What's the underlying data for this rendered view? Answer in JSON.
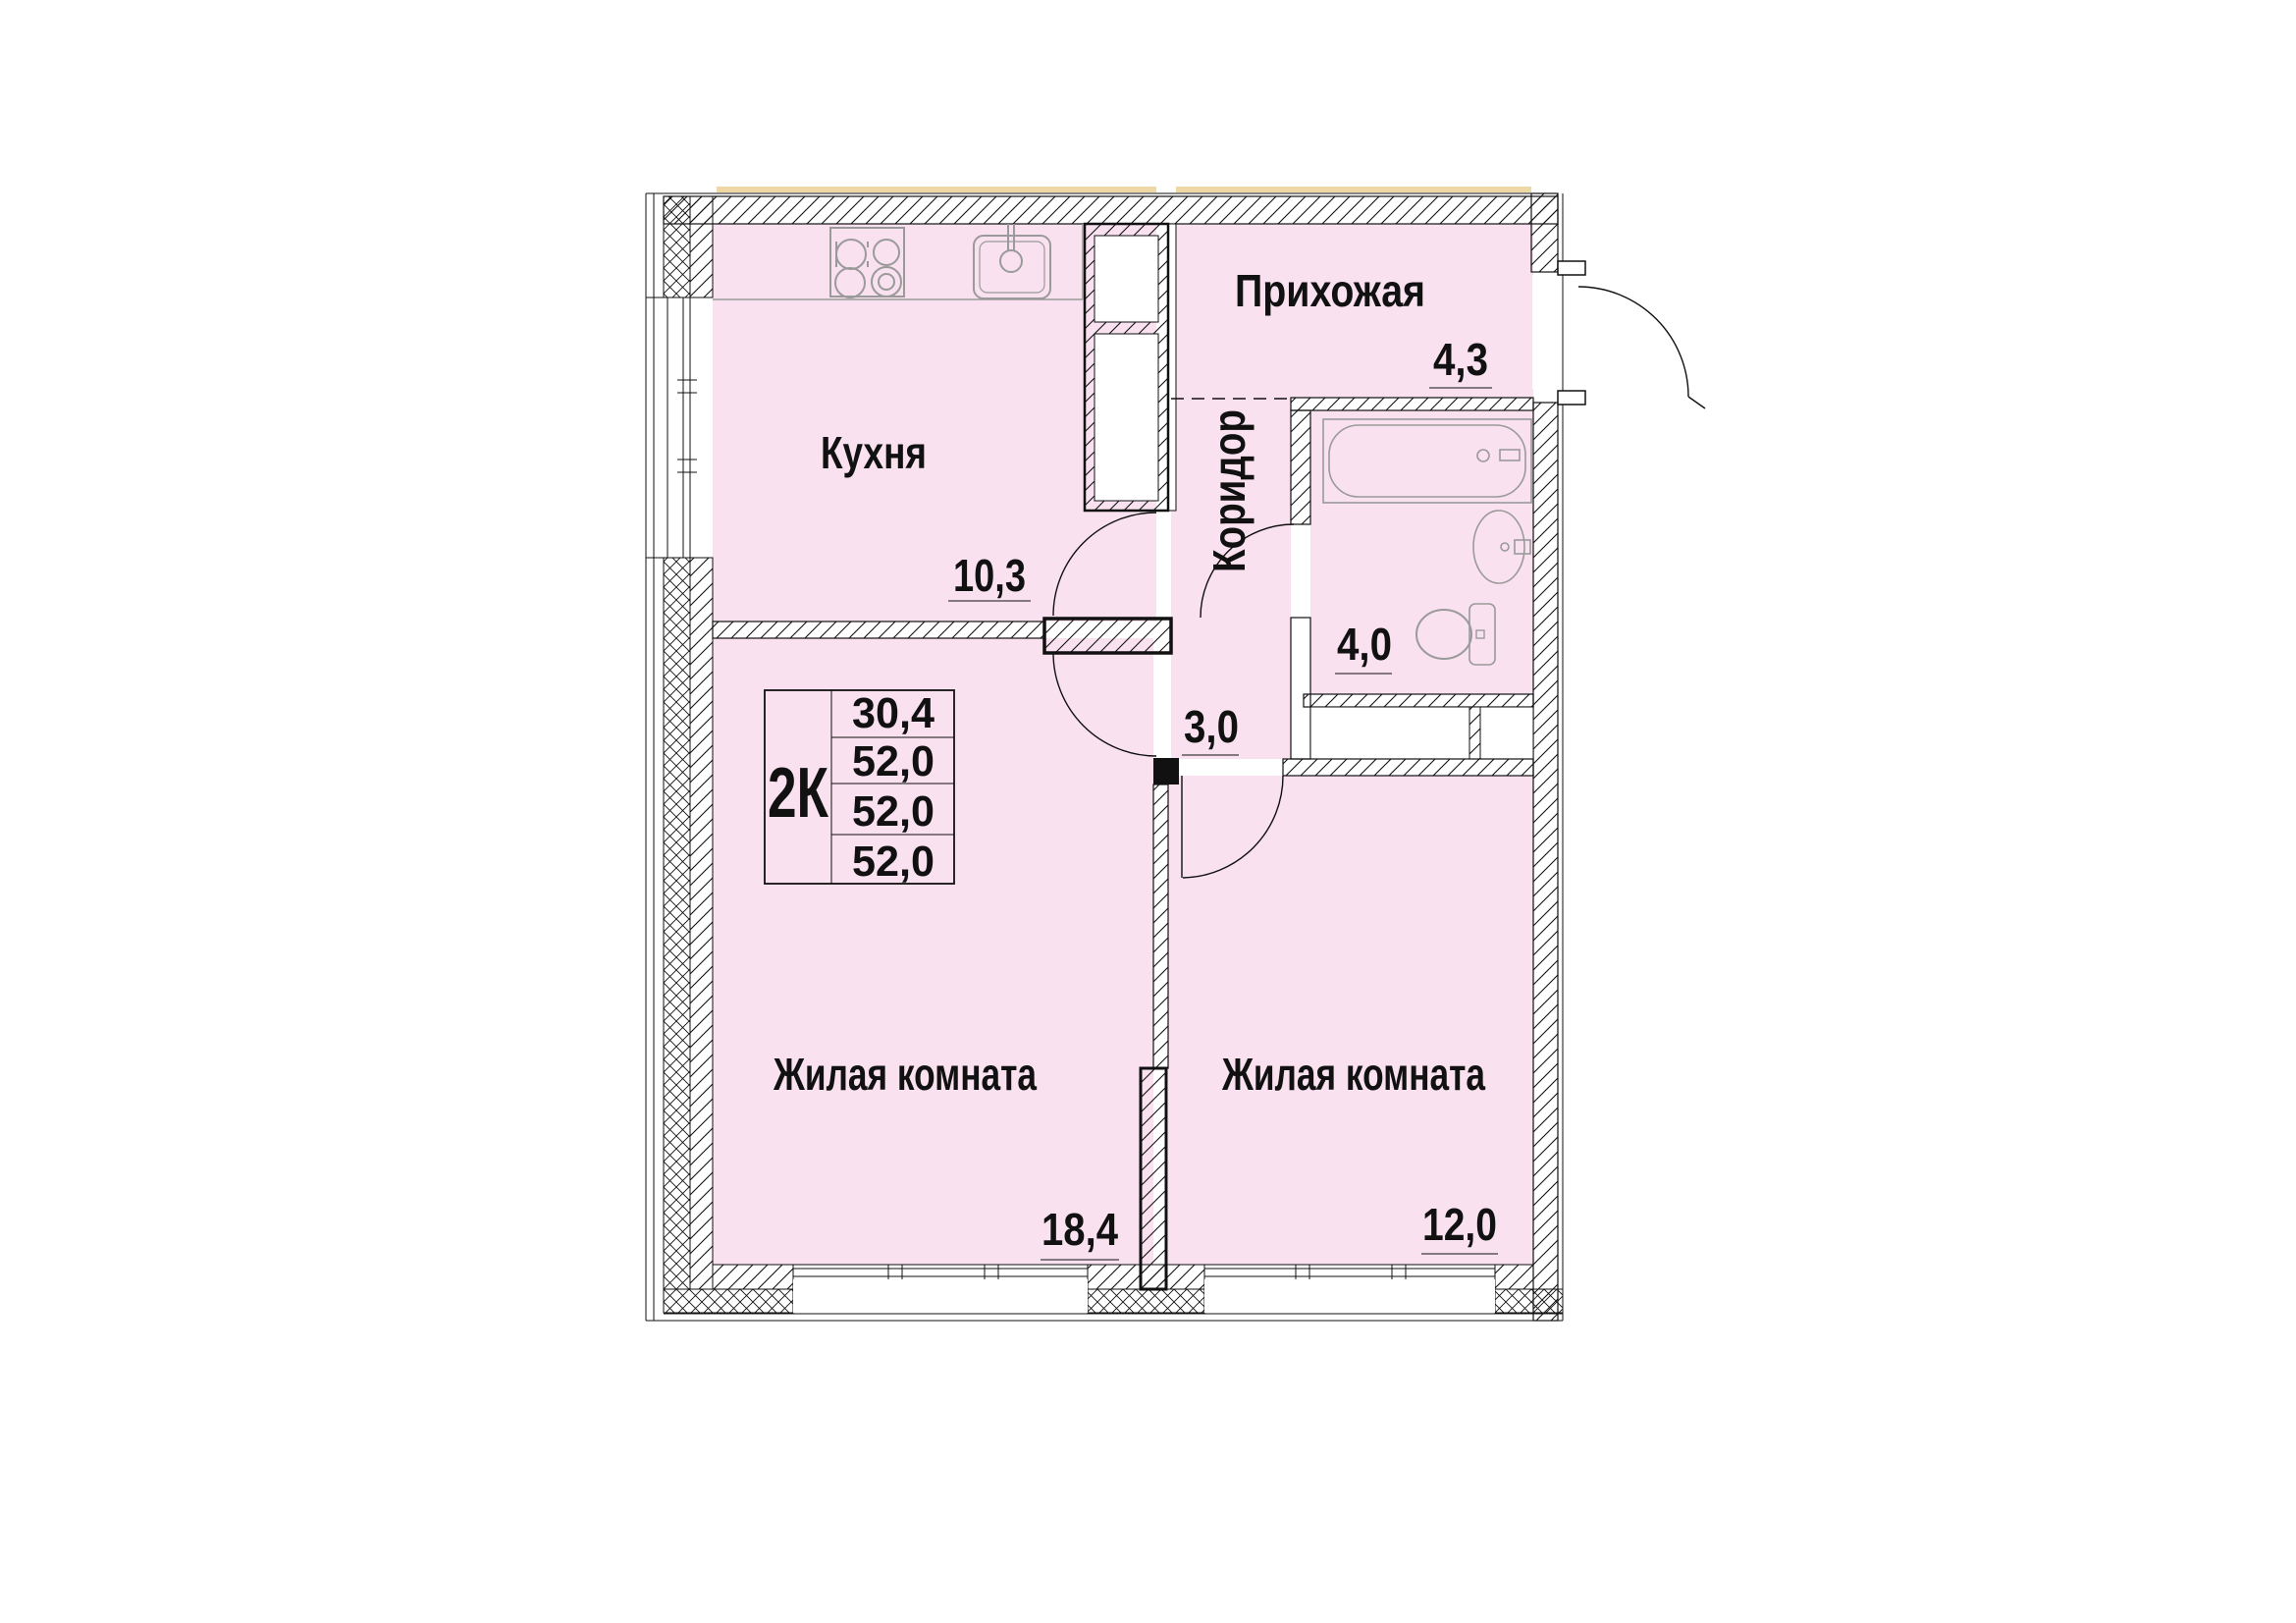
{
  "floor_plan": {
    "summary": {
      "type_label": "2К",
      "rows": [
        "30,4",
        "52,0",
        "52,0",
        "52,0"
      ]
    },
    "rooms": [
      {
        "id": "kitchen",
        "label": "Кухня",
        "area": "10,3"
      },
      {
        "id": "hallway",
        "label": "Прихожая",
        "area": "4,3"
      },
      {
        "id": "corridor",
        "label": "Коридор",
        "area": "3,0"
      },
      {
        "id": "bathroom",
        "label": "",
        "area": "4,0"
      },
      {
        "id": "living-room-1",
        "label": "Жилая комната",
        "area": "18,4"
      },
      {
        "id": "living-room-2",
        "label": "Жилая комната",
        "area": "12,0"
      }
    ],
    "colors": {
      "room_fill": "#f9e1ef",
      "line": "#111111",
      "fixture_line": "#9a9a9a",
      "slab_line": "#eed9a6"
    }
  }
}
